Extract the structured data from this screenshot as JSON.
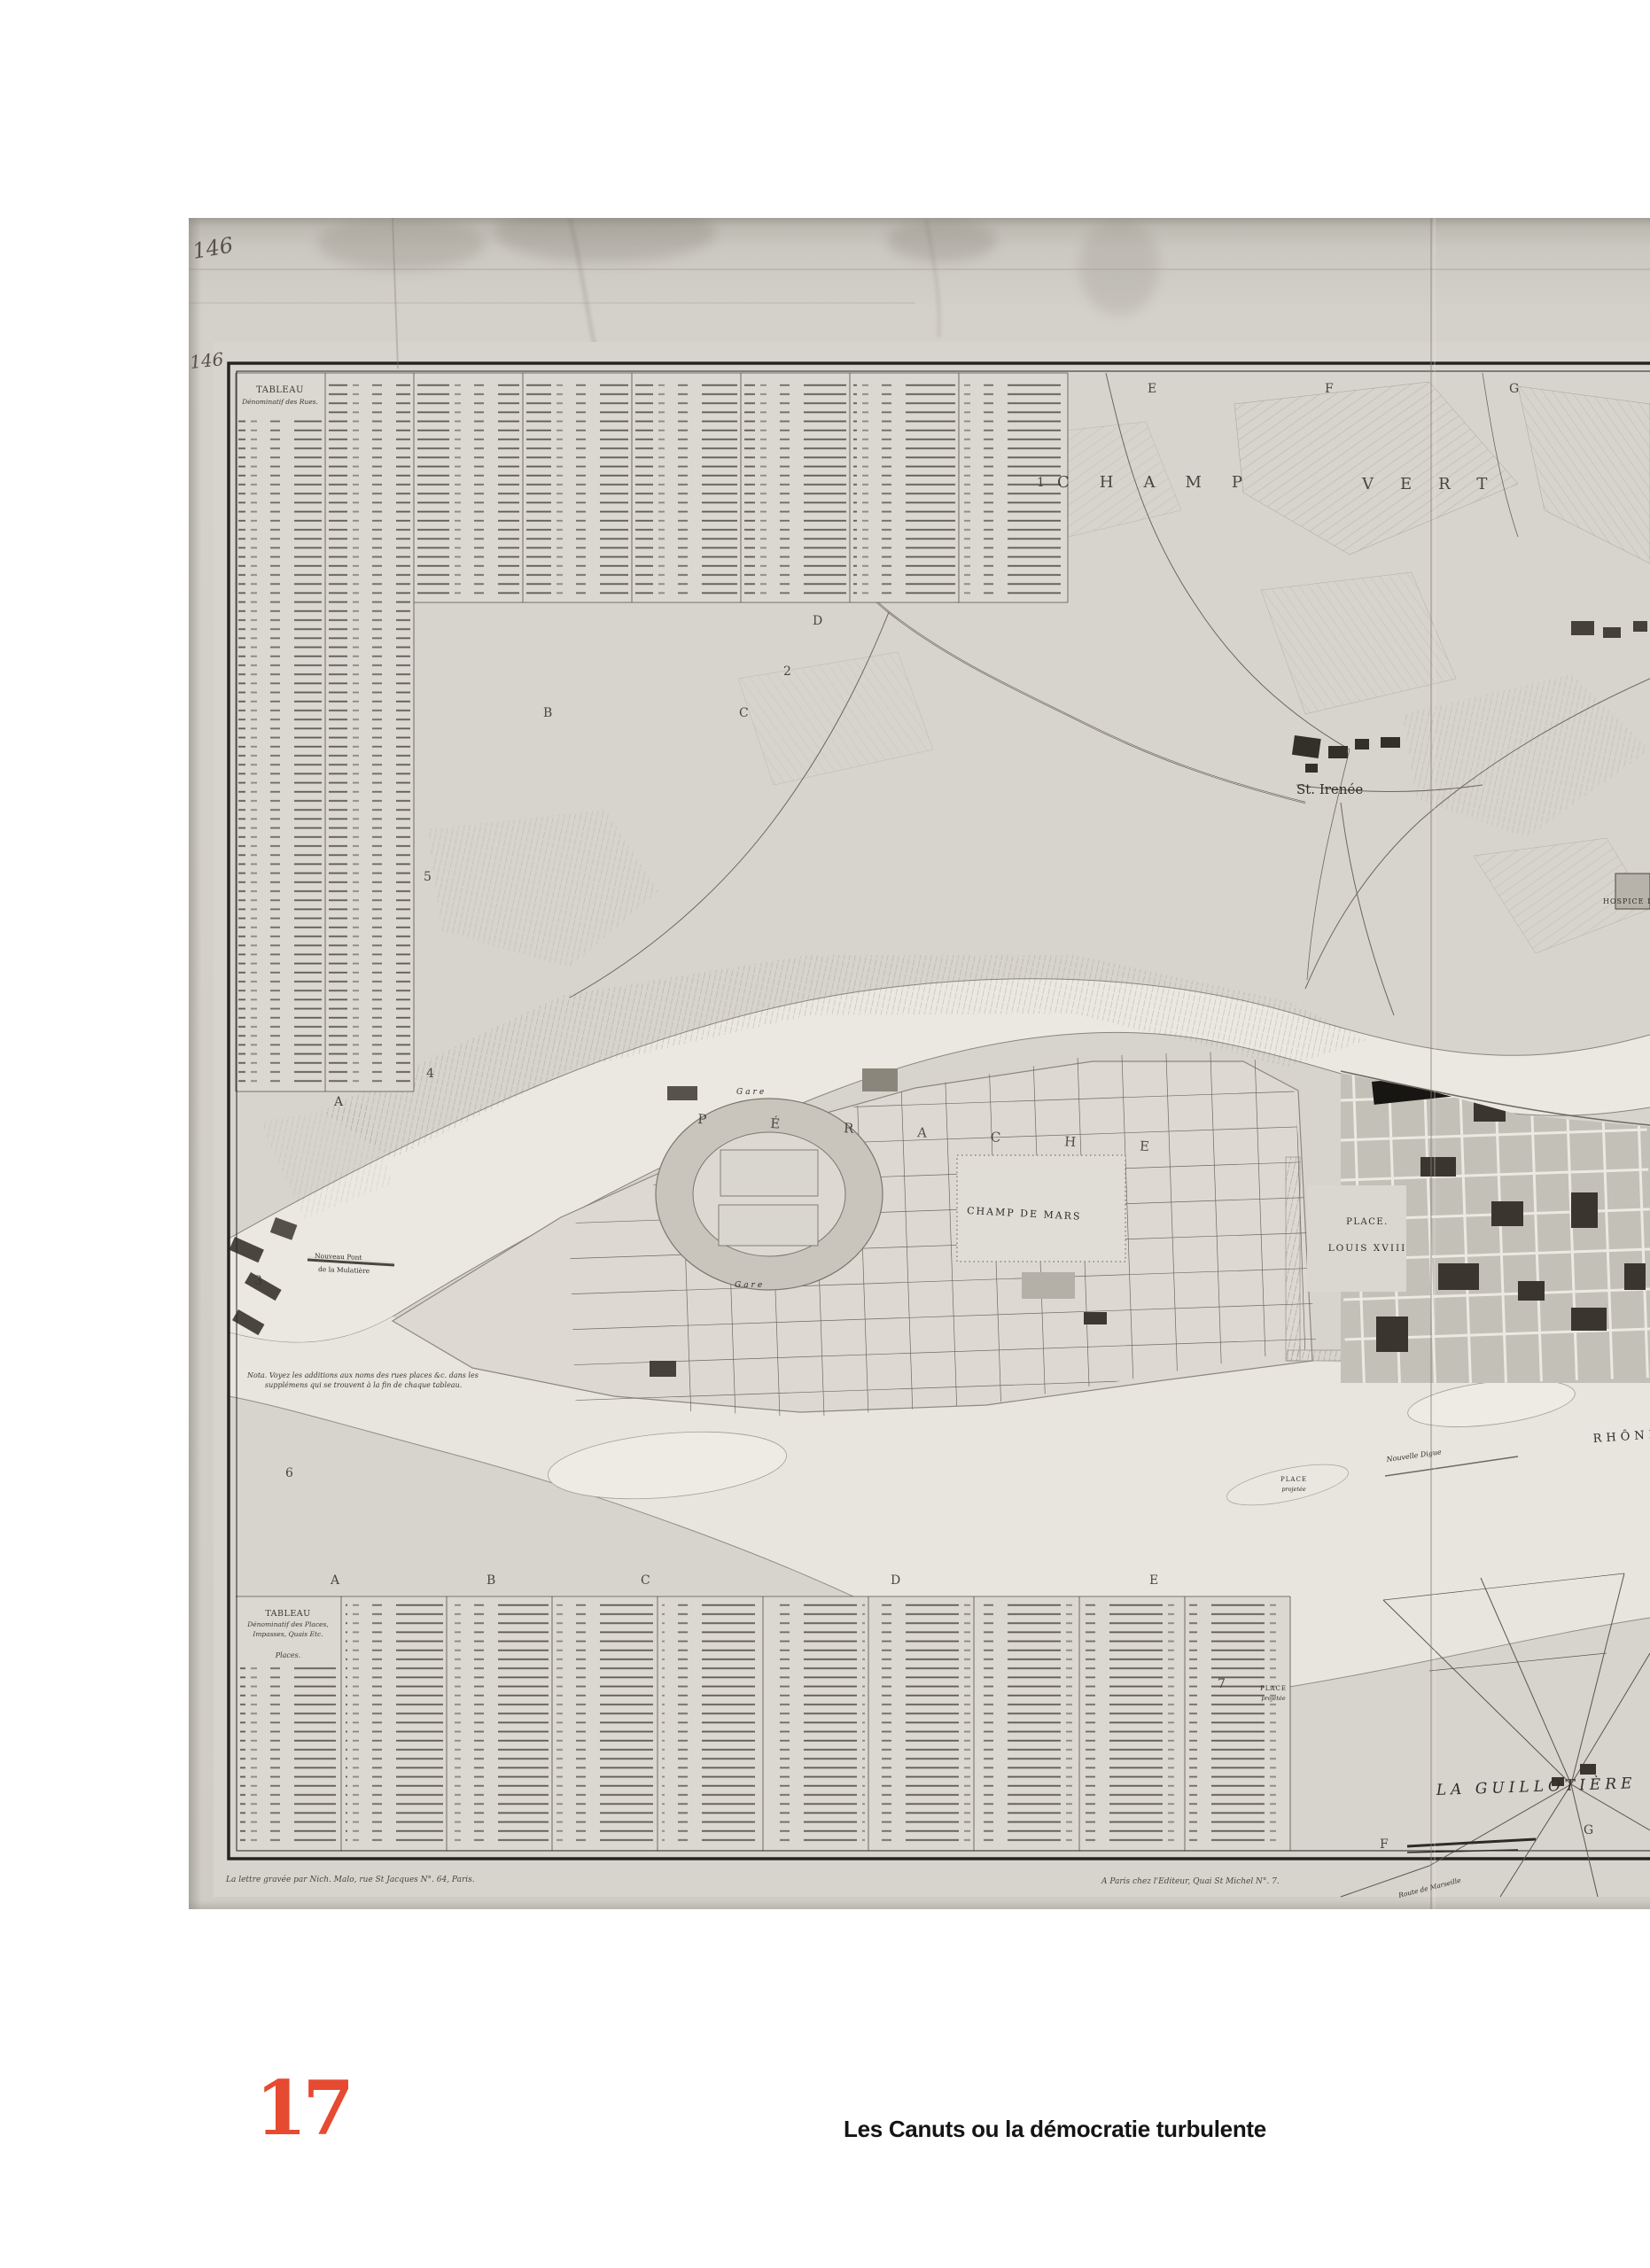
{
  "page": {
    "number": "17",
    "caption": "Les Canuts ou la démocratie turbulente",
    "accent_color": "#e64a31"
  },
  "scan": {
    "handwritten_number": "146",
    "grid_letters": {
      "A": "A",
      "B": "B",
      "C": "C",
      "D": "D",
      "E": "E",
      "F": "F",
      "G": "G"
    },
    "grid_numbers": {
      "n1": "1",
      "n2": "2",
      "n3": "3",
      "n4": "4",
      "n5": "5",
      "n6": "6",
      "n7": "7"
    },
    "tables": {
      "streets": {
        "title": "TABLEAU",
        "subtitle": "Dénominatif des Rues."
      },
      "places": {
        "title": "TABLEAU",
        "subtitle": "Dénominatif des Places,",
        "subtitle2": "Impasses, Quais Etc.",
        "section": "Places."
      }
    },
    "note": {
      "line1": "Nota. Voyez les additions aux noms des rues places &c. dans les",
      "line2": "supplémens qui se trouvent à la fin de chaque tableau."
    },
    "imprints": {
      "left": "La lettre gravée par Nich. Malo, rue St Jacques N°. 64, Paris.",
      "center": "A Paris chez l'Editeur, Quai St Michel N°. 7."
    },
    "labels": {
      "champ": "CHAMP",
      "vert": "VERT",
      "st_irenee": "St. Irenée",
      "perrache": "PÉRACHE",
      "gare": "Gare",
      "champ_de_mars": "CHAMP DE MARS",
      "place_louis_1": "PLACE.",
      "place_louis_2": "LOUIS XVIII",
      "rhone": "RHÔNE",
      "nouvelle_digue": "Nouvelle Digue",
      "la_guillotiere": "LA GUILLOTIÈRE",
      "pont_1": "Nouveau Pont",
      "pont_2": "de la Mulatière",
      "place_proj_1": "PLACE",
      "place_proj_2": "projetée",
      "hospice": "HOSPICE DE",
      "route_marseille": "Route de Marseille"
    }
  }
}
